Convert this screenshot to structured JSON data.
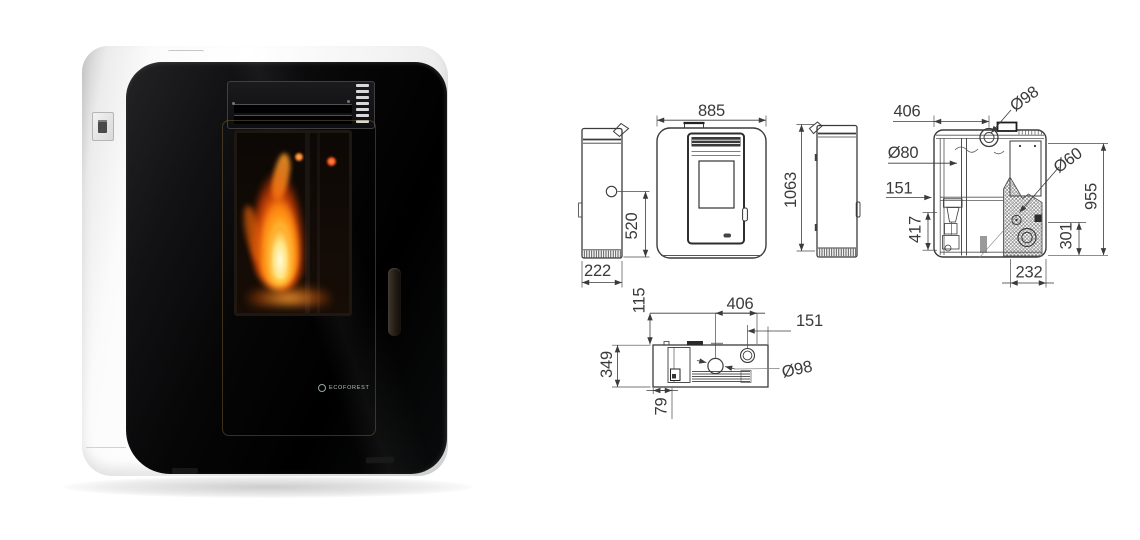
{
  "product_photo": {
    "brand": "ECOFOREST",
    "description": "white pellet stove, black glass front, burning flame"
  },
  "colors": {
    "drawing_line": "#3b3b3b",
    "flame_accent": "#ff8c1a",
    "glass_black": "#0a0a0c",
    "body_white": "#f5f5f5"
  },
  "dimensions": {
    "front_width": "885",
    "overall_height": "1063",
    "side_depth": "222",
    "air_inlet_height": "520",
    "section_top_width": "406",
    "section_flue_diameter": "Ø98",
    "section_pipe_diameter": "Ø80",
    "section_side_offset": "151",
    "section_lower_height": "417",
    "section_burner_diameter": "Ø60",
    "section_body_height": "955",
    "section_outlet_height": "301",
    "section_bottom_width": "232",
    "top_front_offset": "115",
    "top_rear_width": "406",
    "top_flue_offset": "151",
    "top_depth": "349",
    "top_corner_offset": "79",
    "top_flue_diameter": "Ø98"
  }
}
